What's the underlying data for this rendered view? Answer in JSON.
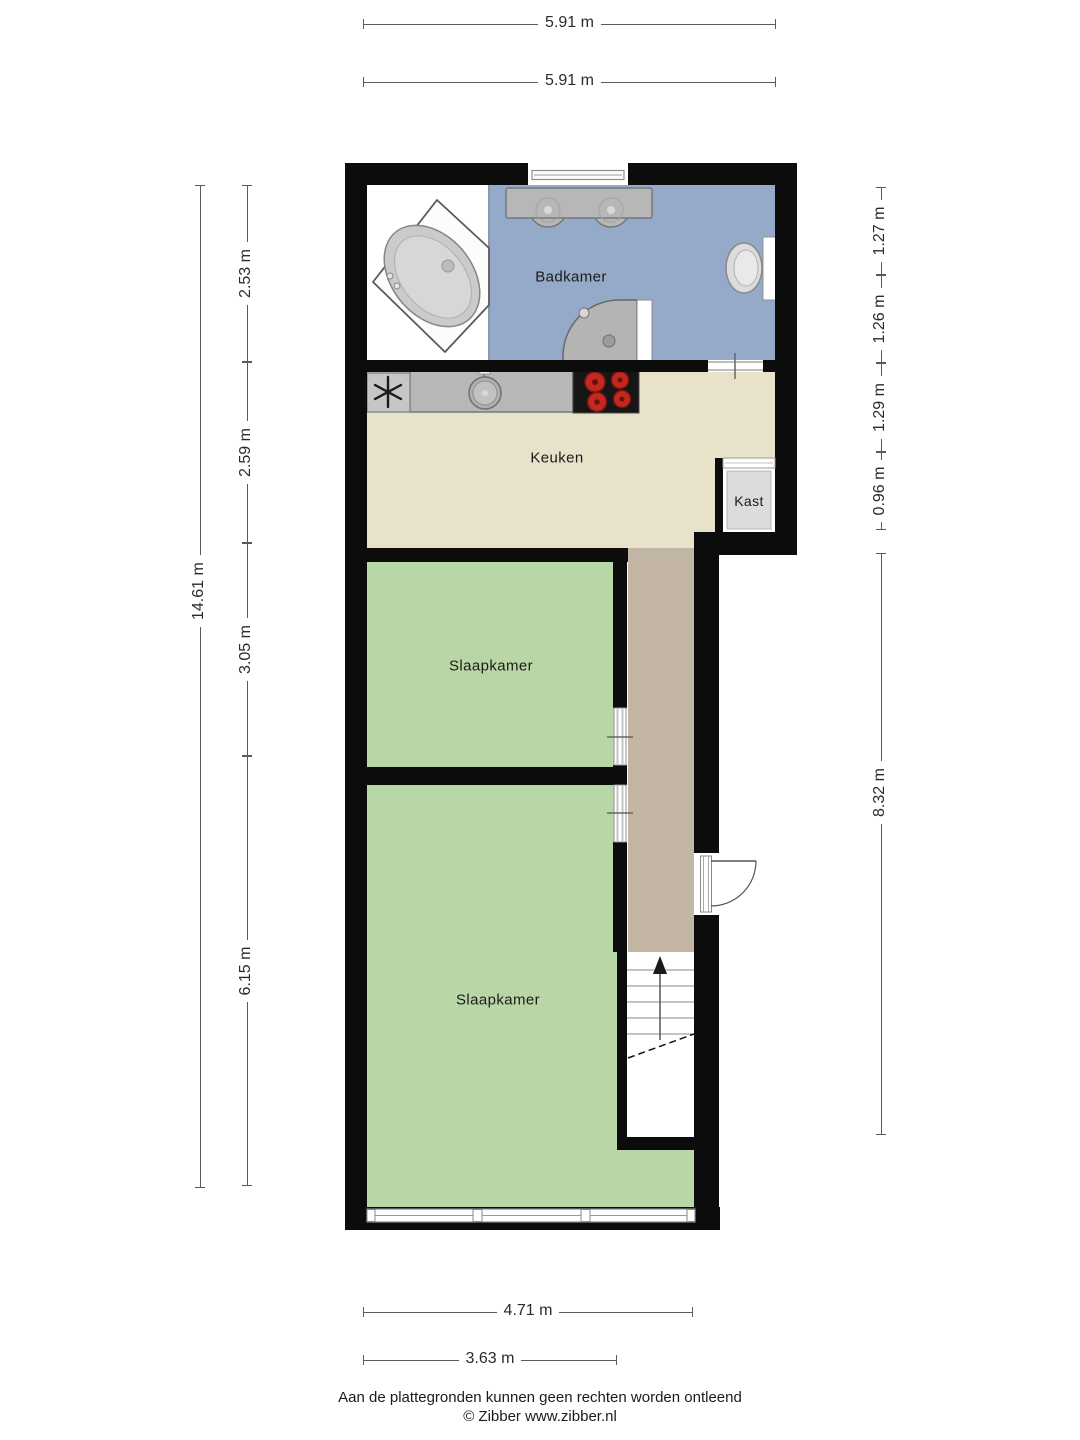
{
  "rooms": {
    "badkamer": "Badkamer",
    "keuken": "Keuken",
    "kast": "Kast",
    "slaapkamer_1": "Slaapkamer",
    "slaapkamer_2": "Slaapkamer"
  },
  "dimensions": {
    "top": [
      "5.91 m",
      "5.91 m"
    ],
    "left_total": "14.61 m",
    "left_segments": [
      "2.53 m",
      "2.59 m",
      "3.05 m",
      "6.15 m"
    ],
    "right_segments": [
      "1.27 m",
      "1.26 m",
      "1.29 m",
      "0.96 m"
    ],
    "right_total": "8.32 m",
    "bottom": [
      "4.71 m",
      "3.63 m"
    ]
  },
  "footer": {
    "disclaimer": "Aan de plattegronden kunnen geen rechten worden ontleend",
    "copyright": "© Zibber www.zibber.nl"
  },
  "icons": {
    "stairs_direction": "up-arrow-icon",
    "ventilation_unit": "asterisk-icon",
    "entrance_door": "door-swing-arc-icon"
  },
  "colors": {
    "bathroom_floor": "#95a9c8",
    "kitchen_floor": "#e9e2ca",
    "bedroom_floor": "#b9d7a6",
    "hallway_floor": "#c3b5a4",
    "closet_floor": "#dcdcdc",
    "wall": "#0c0c0c",
    "fixture_gray": "#b7b7b7",
    "burner_red": "#c4291f"
  }
}
